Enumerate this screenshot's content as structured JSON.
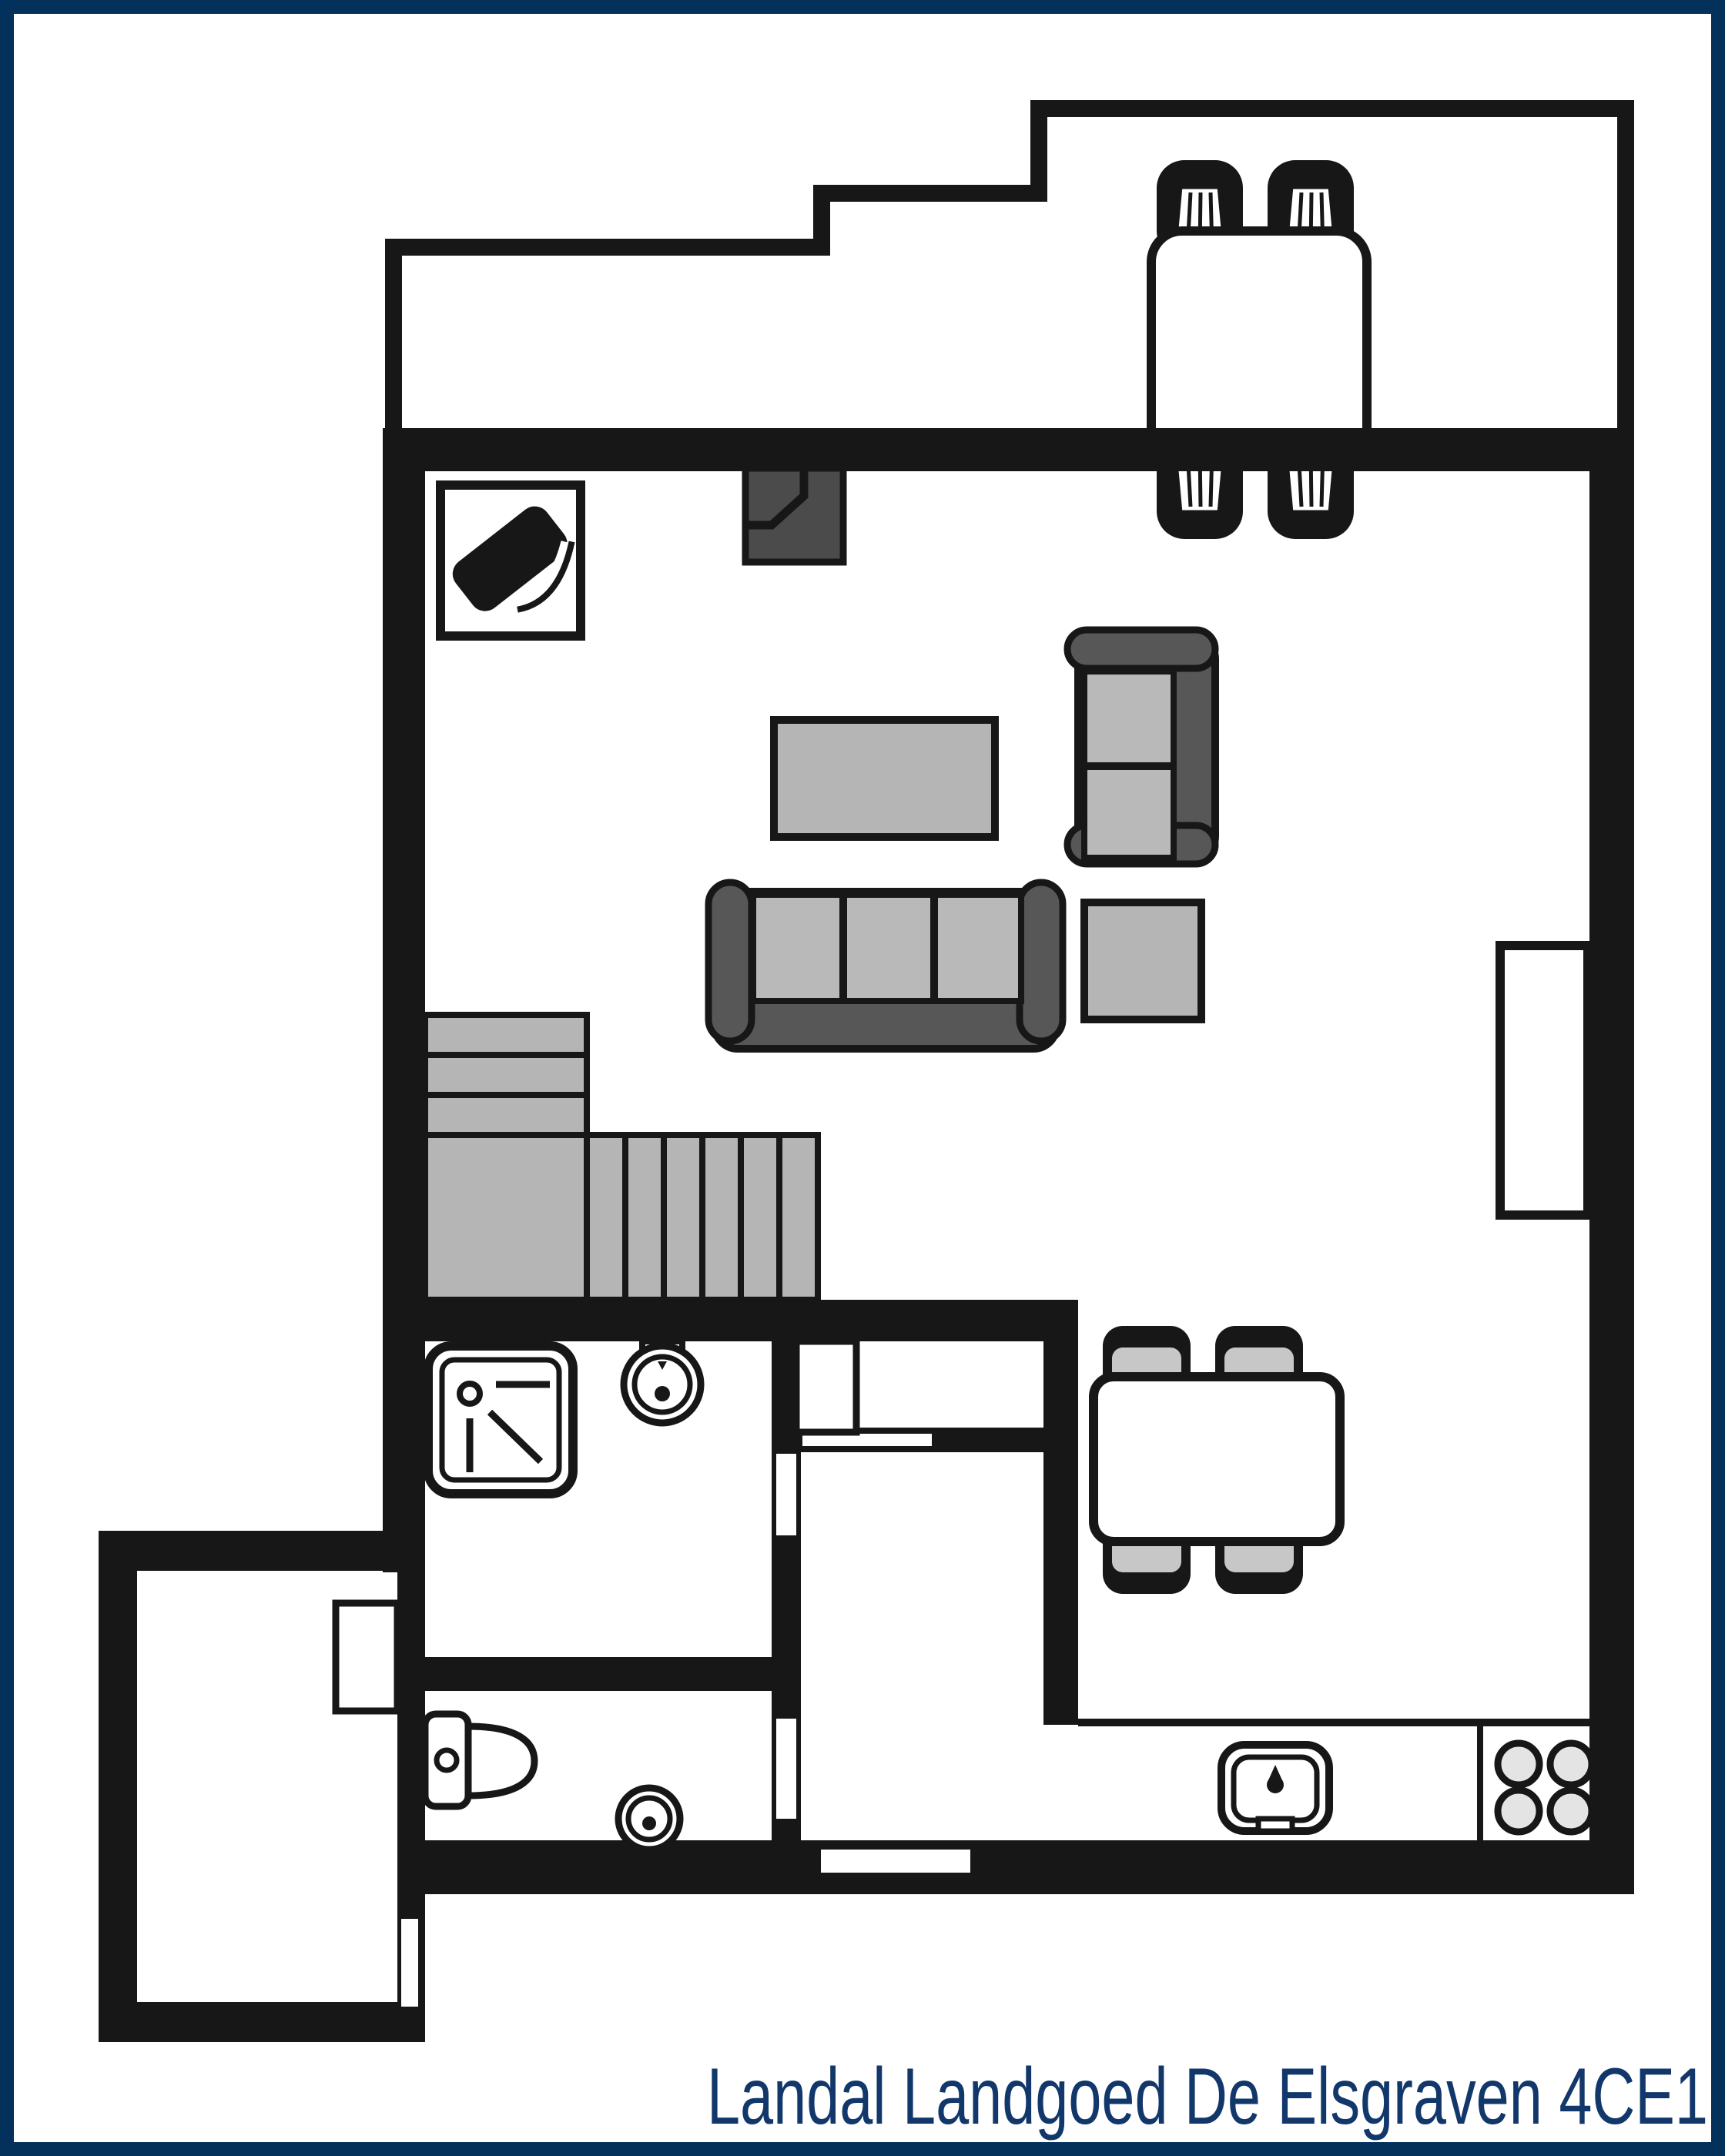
{
  "title": {
    "text": "Landal Landgoed De Elsgraven 4CE1",
    "color": "#12376B"
  },
  "palette": {
    "frame-blue": "#04305C",
    "wall-black": "#171717",
    "furniture-dark": "#4B4B4B",
    "sofa-frame": "#575757",
    "cushion-gray": "#B9B9B9",
    "surface-gray": "#B5B5B5",
    "seat-gray": "#C7C7C7",
    "burner-gray": "#E4E4E4",
    "floor-white": "#FFFFFF"
  },
  "plan": {
    "type": "floorplan",
    "rooms": [
      "terrace",
      "living-room",
      "dining-area",
      "kitchen",
      "stairs",
      "closet",
      "hallway",
      "bathroom",
      "toilet",
      "storage-shed"
    ],
    "furniture_icons": [
      "outdoor-dining-table-icon",
      "outdoor-chair-icon",
      "tv-cabinet-icon",
      "fireplace-icon",
      "rug-icon",
      "two-seat-sofa-icon",
      "three-seat-sofa-icon",
      "side-table-icon",
      "sideboard-icon",
      "staircase-icon",
      "shower-icon",
      "washbasin-icon",
      "toilet-icon",
      "hand-basin-icon",
      "dining-table-icon",
      "dining-chair-icon",
      "kitchen-sink-icon",
      "stove-burners-icon",
      "cupboard-icon",
      "door-opening"
    ]
  }
}
